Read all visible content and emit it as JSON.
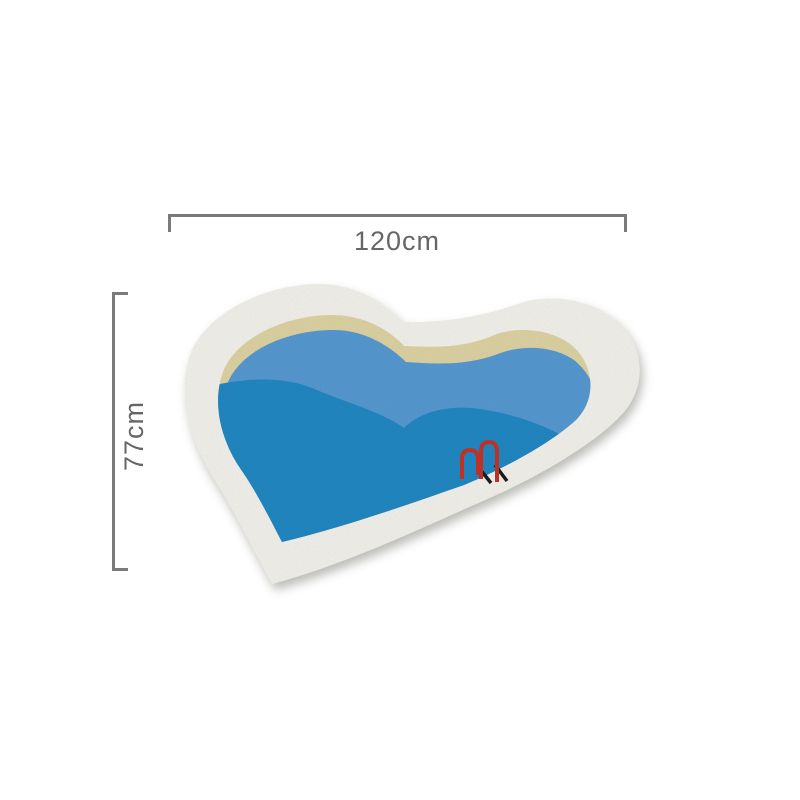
{
  "product": {
    "name": "heart-shaped pool rug",
    "width_label": "120cm",
    "height_label": "77cm"
  },
  "colors": {
    "background": "#ffffff",
    "rug_border": "#f2f1ec",
    "sand_band": "#ddd2a2",
    "water_light": "#5598d0",
    "water_dark": "#2187c1",
    "ladder_red": "#c43228",
    "ladder_shadow": "#1c1c1c",
    "dimension_line": "#7b7b7b",
    "dimension_text": "#666666"
  }
}
